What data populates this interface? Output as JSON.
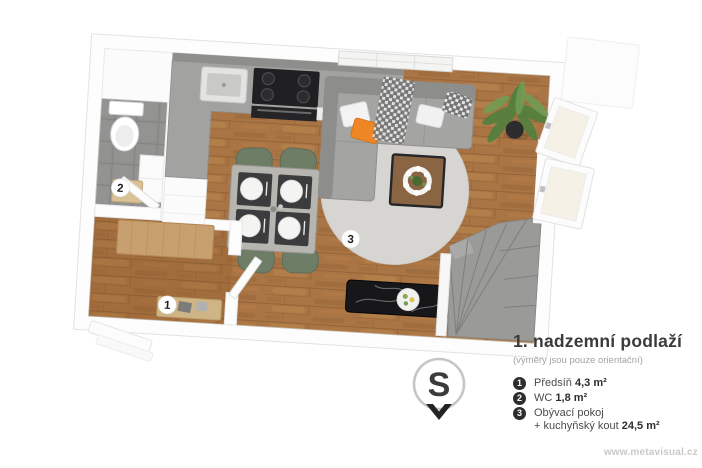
{
  "plan": {
    "badges": [
      {
        "number": "1"
      },
      {
        "number": "2"
      },
      {
        "number": "3"
      }
    ],
    "colors": {
      "wood_floor": "#aa7544",
      "wc_tile": "#90908e",
      "counter_gray": "#a2a2a0",
      "sofa_gray": "#a4a4a2",
      "rug_gray": "#d7d5d1",
      "chair_green": "#6e7d66",
      "table_gray": "#b7b5b0",
      "accent_orange": "#ef8626",
      "marble_black": "#17171a",
      "stairs_gray": "#9a9a98",
      "wardrobe_oak": "#c89f6e"
    }
  },
  "compass": {
    "label": "S"
  },
  "legend": {
    "title": "1. nadzemní podlaží",
    "subtitle": "(výměry jsou pouze orientační)",
    "items": [
      {
        "number": "1",
        "label": "Předsíň",
        "area": "4,3 m²"
      },
      {
        "number": "2",
        "label": "WC",
        "area": "1,8 m²"
      },
      {
        "number": "3",
        "label": "Obývací pokoj",
        "label2": "+ kuchyňský kout",
        "area": "24,5 m²"
      }
    ]
  },
  "watermark": {
    "text": "www.metavisual.cz"
  }
}
